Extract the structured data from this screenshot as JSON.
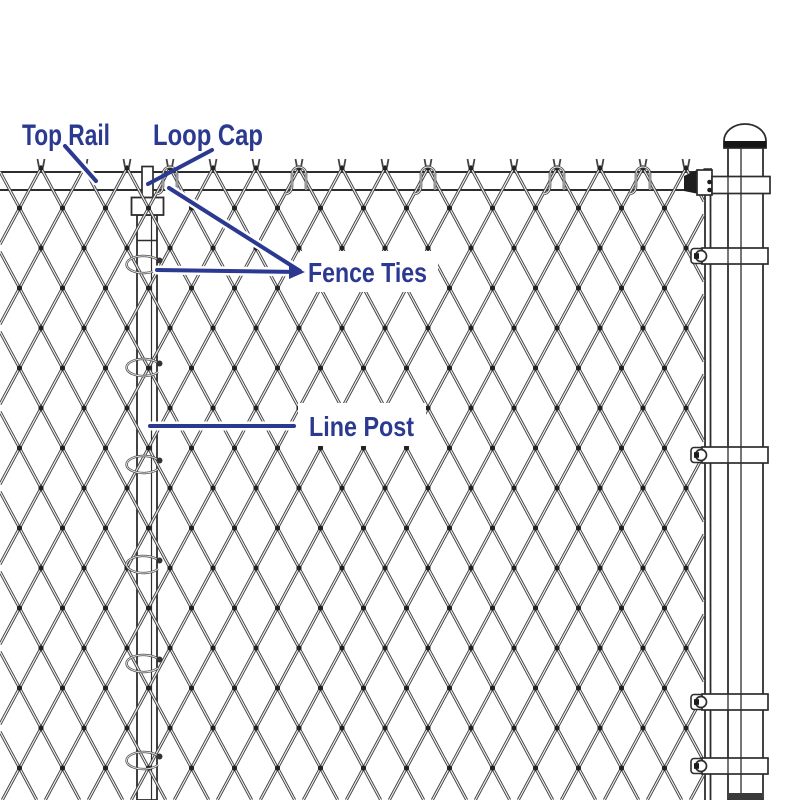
{
  "diagram": {
    "labels": {
      "top_rail": "Top Rail",
      "loop_cap": "Loop Cap",
      "fence_ties": "Fence Ties",
      "line_post": "Line Post"
    },
    "colors": {
      "label_blue": "#2b3990",
      "wire_dark": "#3d3d3d",
      "wire_light": "#ededed",
      "hardware_outline": "#2d2d2d",
      "background": "#ffffff"
    }
  }
}
